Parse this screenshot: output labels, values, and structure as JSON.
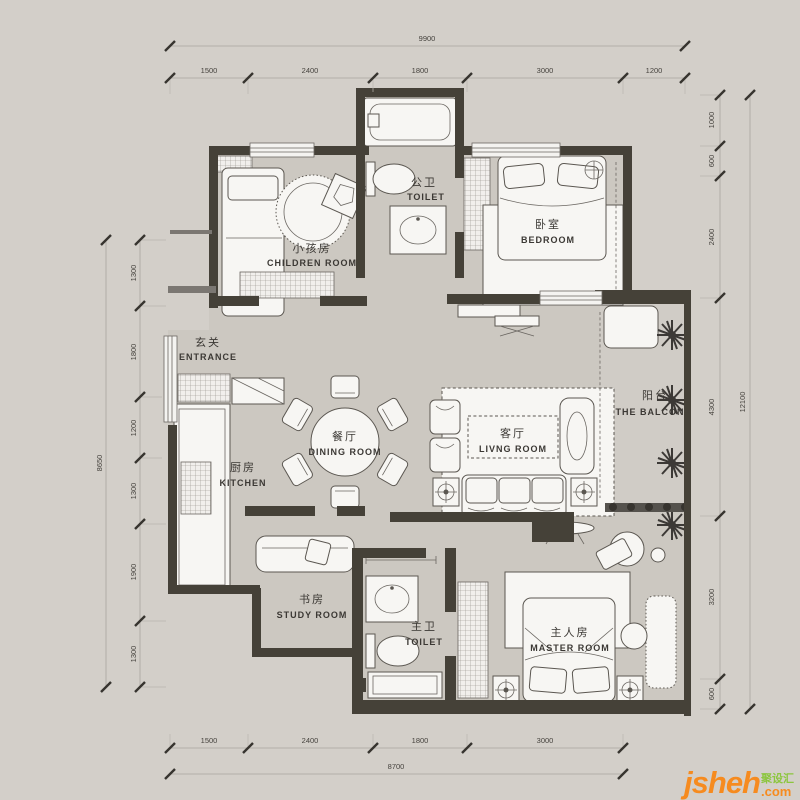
{
  "rooms": {
    "children": {
      "cn": "小孩房",
      "en": "CHILDREN  ROOM"
    },
    "public_toilet": {
      "cn": "公卫",
      "en": "TOILET"
    },
    "bedroom": {
      "cn": "卧室",
      "en": "BEDROOM"
    },
    "entrance": {
      "cn": "玄关",
      "en": "ENTRANCE"
    },
    "kitchen": {
      "cn": "厨房",
      "en": "KITCHEN"
    },
    "dining": {
      "cn": "餐厅",
      "en": "DINING  ROOM"
    },
    "living": {
      "cn": "客厅",
      "en": "LIVNG  ROOM"
    },
    "balcony": {
      "cn": "阳台",
      "en": "THE  BALCON"
    },
    "study": {
      "cn": "书房",
      "en": "STUDY  ROOM"
    },
    "master_toilet": {
      "cn": "主卫",
      "en": "TOILET"
    },
    "master": {
      "cn": "主人房",
      "en": "MASTER  ROOM"
    }
  },
  "dimensions": {
    "top": {
      "total": "9900",
      "segments": [
        "1500",
        "2400",
        "1800",
        "3000",
        "1200"
      ]
    },
    "bottom": {
      "total": "8700",
      "segments": [
        "1500",
        "2400",
        "1800",
        "3000"
      ]
    },
    "left": {
      "total": "8650",
      "segments": [
        "1300",
        "1800",
        "1200",
        "1300",
        "1900",
        "1300"
      ]
    },
    "right": {
      "total": "12100",
      "segments": [
        "1000",
        "600",
        "2400",
        "4300",
        "3200",
        "600"
      ]
    }
  },
  "watermark": {
    "brand": "jsheh",
    "domain": ".com",
    "cn": "聚设汇"
  },
  "colors": {
    "background": "#d3cfc9",
    "floor": "#ccc8c1",
    "wall": "#454138",
    "accent_orange": "#f68b1f",
    "accent_green": "#8cc63e"
  }
}
